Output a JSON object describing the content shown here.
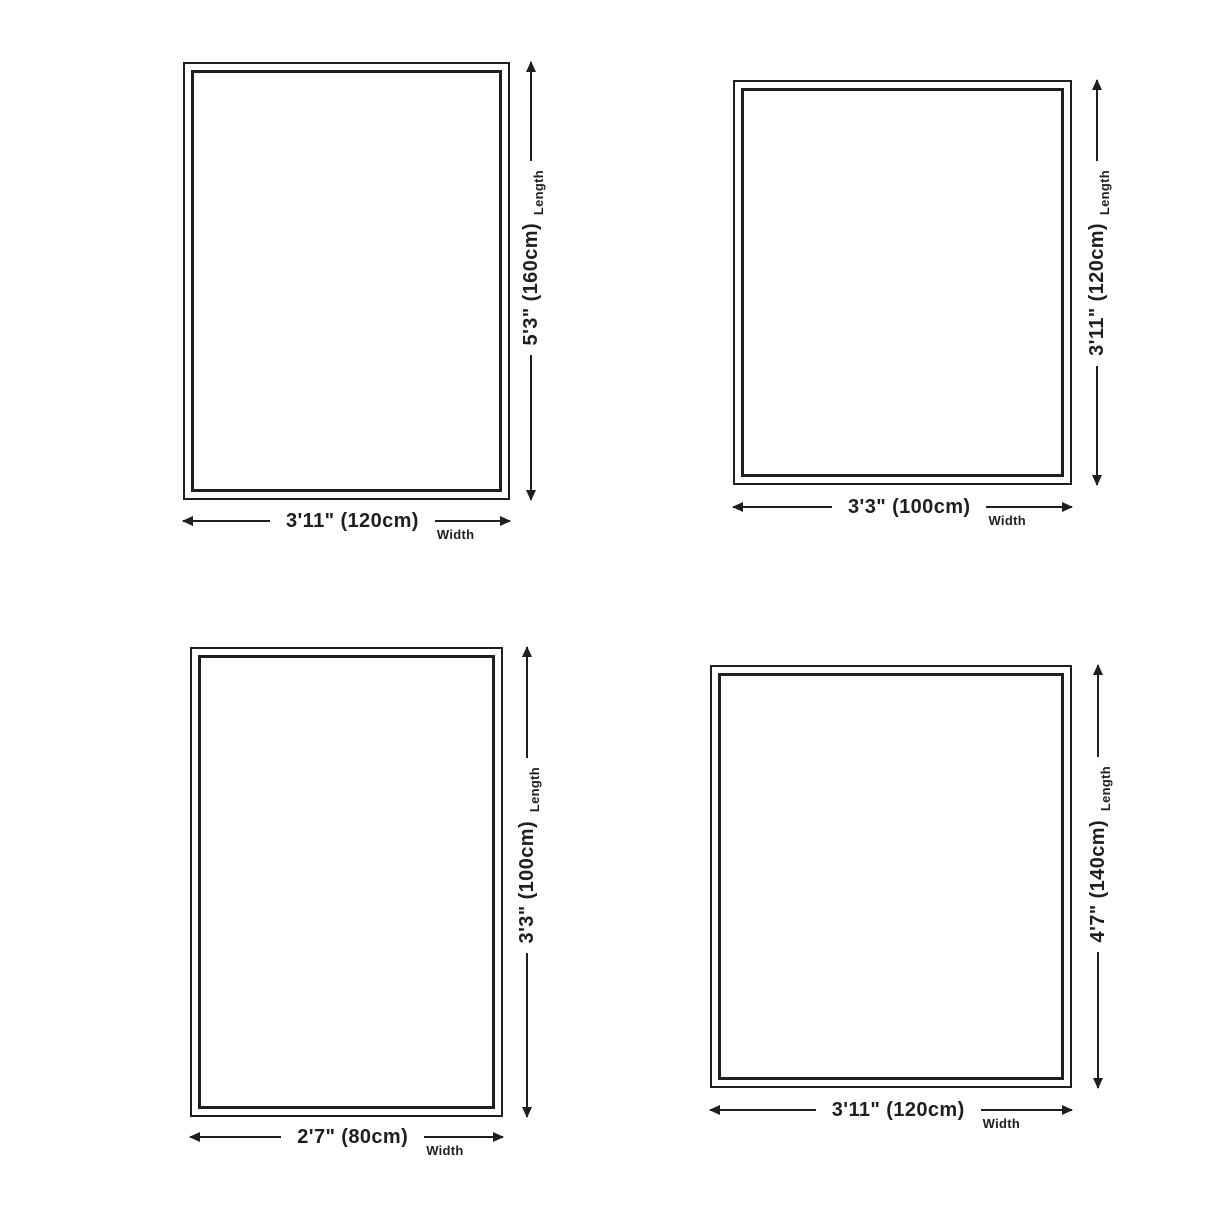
{
  "title": "Rug size diagrams",
  "colors": {
    "line": "#1f1f1f",
    "background": "#ffffff"
  },
  "figures": [
    {
      "position": "top-left",
      "length": {
        "value": "5'3\" (160cm)",
        "label": "Length"
      },
      "width": {
        "value": "3'11\" (120cm)",
        "label": "Width"
      }
    },
    {
      "position": "top-right",
      "length": {
        "value": "3'11\" (120cm)",
        "label": "Length"
      },
      "width": {
        "value": "3'3\" (100cm)",
        "label": "Width"
      }
    },
    {
      "position": "bottom-left",
      "length": {
        "value": "3'3\" (100cm)",
        "label": "Length"
      },
      "width": {
        "value": "2'7\" (80cm)",
        "label": "Width"
      }
    },
    {
      "position": "bottom-right",
      "length": {
        "value": "4'7\" (140cm)",
        "label": "Length"
      },
      "width": {
        "value": "3'11\" (120cm)",
        "label": "Width"
      }
    }
  ]
}
